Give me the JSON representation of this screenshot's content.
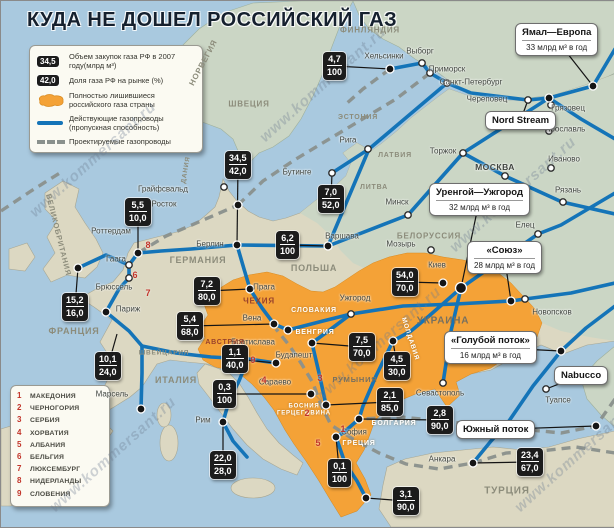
{
  "title": "КУДА НЕ ДОШЕЛ РОССИЙСКИЙ ГАЗ",
  "watermark_text": "www.kommersant.ru",
  "colors": {
    "sea": "#A9C9DF",
    "land_west": "#DCD8C2",
    "land_east": "#CBD6C5",
    "orange": "#F4A237",
    "pipeline_active": "#1474B8",
    "pipeline_planned": "#8A918D",
    "databox": "#1C1C1C",
    "red": "#C2342A"
  },
  "legend": {
    "purchases_value": "34,5",
    "purchases_label": "Объем закупок газа РФ в 2007 году(млрд м³)",
    "share_value": "42,0",
    "share_label": "Доля газа РФ на рынке (%)",
    "orange_label": "Полностью лишившиеся российского газа страны",
    "active_label": "Действующие газопроводы (пропускная способность)",
    "planned_label": "Проектируемые газопроводы"
  },
  "numbered_countries": [
    {
      "n": "1",
      "name": "МАКЕДОНИЯ"
    },
    {
      "n": "2",
      "name": "ЧЕРНОГОРИЯ"
    },
    {
      "n": "3",
      "name": "СЕРБИЯ"
    },
    {
      "n": "4",
      "name": "ХОРВАТИЯ"
    },
    {
      "n": "5",
      "name": "АЛБАНИЯ"
    },
    {
      "n": "6",
      "name": "БЕЛЬГИЯ"
    },
    {
      "n": "7",
      "name": "ЛЮКСЕМБУРГ"
    },
    {
      "n": "8",
      "name": "НИДЕРЛАНДЫ"
    },
    {
      "n": "9",
      "name": "СЛОВЕНИЯ"
    }
  ],
  "callouts": [
    {
      "id": "yamal-europe",
      "t": "Ямал—Европа",
      "s": "33 млрд м³ в год",
      "x": 514,
      "y": 22,
      "ax": 592,
      "ay": 85
    },
    {
      "id": "nord-stream",
      "t": "Nord Stream",
      "s": null,
      "x": 484,
      "y": 110,
      "ax": 527,
      "ay": 99
    },
    {
      "id": "urengoy-uzhgorod",
      "t": "Уренгой—Ужгород",
      "s": "32 млрд м³ в год",
      "x": 428,
      "y": 182,
      "ax": 460,
      "ay": 287
    },
    {
      "id": "soyuz",
      "t": "«Союз»",
      "s": "28 млрд м³ в год",
      "x": 466,
      "y": 240,
      "ax": 510,
      "ay": 300
    },
    {
      "id": "blue-stream",
      "t": "«Голубой поток»",
      "s": "16 млрд м³ в год",
      "x": 443,
      "y": 330,
      "ax": 560,
      "ay": 350
    },
    {
      "id": "nabucco",
      "t": "Nabucco",
      "s": null,
      "x": 553,
      "y": 365,
      "ax": 545,
      "ay": 388
    },
    {
      "id": "south-stream",
      "t": "Южный поток",
      "s": null,
      "x": 455,
      "y": 419,
      "ax": 595,
      "ay": 425
    }
  ],
  "databoxes": [
    {
      "a": "4,7",
      "b": "100",
      "x": 322,
      "y": 51,
      "ax": 389,
      "ay": 68
    },
    {
      "a": "34,5",
      "b": "42,0",
      "x": 224,
      "y": 150,
      "ax": 236,
      "ay": 244
    },
    {
      "a": "7,0",
      "b": "52,0",
      "x": 317,
      "y": 184,
      "ax": 331,
      "ay": 172
    },
    {
      "a": "5,5",
      "b": "10,0",
      "x": 124,
      "y": 197,
      "ax": 137,
      "ay": 252
    },
    {
      "a": "6,2",
      "b": "100",
      "x": 275,
      "y": 230,
      "ax": 327,
      "ay": 245
    },
    {
      "a": "15,2",
      "b": "16,0",
      "x": 61,
      "y": 292,
      "ax": 77,
      "ay": 267
    },
    {
      "a": "7,2",
      "b": "80,0",
      "x": 193,
      "y": 276,
      "ax": 249,
      "ay": 288
    },
    {
      "a": "5,4",
      "b": "68,0",
      "x": 176,
      "y": 311,
      "ax": 273,
      "ay": 323
    },
    {
      "a": "10,1",
      "b": "24,0",
      "x": 94,
      "y": 351,
      "ax": 116,
      "ay": 333
    },
    {
      "a": "1,1",
      "b": "40,0",
      "x": 221,
      "y": 344,
      "ax": 275,
      "ay": 362
    },
    {
      "a": "0,3",
      "b": "100",
      "x": 212,
      "y": 379,
      "ax": 310,
      "ay": 393
    },
    {
      "a": "22,0",
      "b": "28,0",
      "x": 209,
      "y": 450,
      "ax": 222,
      "ay": 421
    },
    {
      "a": "54,0",
      "b": "70,0",
      "x": 391,
      "y": 267,
      "ax": 442,
      "ay": 282
    },
    {
      "a": "7,5",
      "b": "70,0",
      "x": 348,
      "y": 332,
      "ax": 311,
      "ay": 342
    },
    {
      "a": "4,5",
      "b": "30,0",
      "x": 383,
      "y": 351,
      "ax": 392,
      "ay": 340
    },
    {
      "a": "2,1",
      "b": "85,0",
      "x": 376,
      "y": 387,
      "ax": 325,
      "ay": 404
    },
    {
      "a": "0,1",
      "b": "100",
      "x": 327,
      "y": 458,
      "ax": 335,
      "ay": 436
    },
    {
      "a": "2,8",
      "b": "90,0",
      "x": 426,
      "y": 405,
      "ax": 358,
      "ay": 418
    },
    {
      "a": "3,1",
      "b": "90,0",
      "x": 392,
      "y": 486,
      "ax": 365,
      "ay": 497
    },
    {
      "a": "23,4",
      "b": "67,0",
      "x": 516,
      "y": 447,
      "ax": 472,
      "ay": 462
    }
  ],
  "cities": [
    {
      "n": "Хельсинки",
      "x": 383,
      "y": 55,
      "dx": 389,
      "dy": 68,
      "dot": "b"
    },
    {
      "n": "Выборг",
      "x": 419,
      "y": 50,
      "dx": 421,
      "dy": 62,
      "dot": "w"
    },
    {
      "n": "Приморск",
      "x": 446,
      "y": 68,
      "dx": 429,
      "dy": 72,
      "dot": "w"
    },
    {
      "n": "Санкт-Петербург",
      "x": 470,
      "y": 81,
      "dx": 446,
      "dy": 82,
      "dot": "w"
    },
    {
      "n": "Череповец",
      "x": 486,
      "y": 98,
      "dx": 527,
      "dy": 99,
      "dot": "w"
    },
    {
      "n": "Грязовец",
      "x": 567,
      "y": 107,
      "dx": 550,
      "dy": 104,
      "dot": "w"
    },
    {
      "n": "Ярославль",
      "x": 564,
      "y": 128,
      "dx": 548,
      "dy": 130,
      "dot": "w"
    },
    {
      "n": "Иваново",
      "x": 563,
      "y": 158,
      "dx": 550,
      "dy": 167,
      "dot": "w"
    },
    {
      "n": "Торжок",
      "x": 442,
      "y": 150,
      "dx": 462,
      "dy": 152,
      "dot": "w"
    },
    {
      "n": "МОСКВА",
      "x": 494,
      "y": 166,
      "dx": 504,
      "dy": 175,
      "dot": "w",
      "caps": true
    },
    {
      "n": "Рязань",
      "x": 567,
      "y": 189,
      "dx": 562,
      "dy": 201,
      "dot": "w"
    },
    {
      "n": "Елец",
      "x": 524,
      "y": 224,
      "dx": 537,
      "dy": 233,
      "dot": "w"
    },
    {
      "n": "Новопсков",
      "x": 551,
      "y": 311,
      "dx": 524,
      "dy": 298,
      "dot": "w"
    },
    {
      "n": "Рига",
      "x": 347,
      "y": 139,
      "dx": 367,
      "dy": 148,
      "dot": "w"
    },
    {
      "n": "Минск",
      "x": 396,
      "y": 201,
      "dx": 407,
      "dy": 214,
      "dot": "w"
    },
    {
      "n": "Варшава",
      "x": 341,
      "y": 235,
      "dx": 327,
      "dy": 245,
      "dot": "b"
    },
    {
      "n": "Мозырь",
      "x": 400,
      "y": 243,
      "dx": 430,
      "dy": 249,
      "dot": "w"
    },
    {
      "n": "Киев",
      "x": 436,
      "y": 264,
      "dx": 442,
      "dy": 282,
      "dot": "b"
    },
    {
      "n": "Ужгород",
      "x": 354,
      "y": 297,
      "dx": 350,
      "dy": 313,
      "dot": "w"
    },
    {
      "n": "Берлин",
      "x": 209,
      "y": 243,
      "dx": 236,
      "dy": 244,
      "dot": "b"
    },
    {
      "n": "Грайфсвальд",
      "x": 162,
      "y": 188,
      "dx": 223,
      "dy": 186,
      "dot": "w"
    },
    {
      "n": "Росток",
      "x": 163,
      "y": 203,
      "dx": 237,
      "dy": 204,
      "dot": "b"
    },
    {
      "n": "Бутинге",
      "x": 296,
      "y": 171,
      "dx": 331,
      "dy": 172,
      "dot": "w"
    },
    {
      "n": "Роттердам",
      "x": 110,
      "y": 230,
      "dx": 137,
      "dy": 252,
      "dot": "b"
    },
    {
      "n": "Гаага",
      "x": 115,
      "y": 258,
      "dx": 128,
      "dy": 264,
      "dot": "w"
    },
    {
      "n": "Брюссель",
      "x": 113,
      "y": 286,
      "dx": 128,
      "dy": 277,
      "dot": "w"
    },
    {
      "n": "Париж",
      "x": 127,
      "y": 308,
      "dx": 105,
      "dy": 311,
      "dot": "b"
    },
    {
      "n": "Марсель",
      "x": 111,
      "y": 393,
      "dx": 140,
      "dy": 408,
      "dot": "b"
    },
    {
      "n": "Прага",
      "x": 263,
      "y": 286,
      "dx": 249,
      "dy": 288,
      "dot": "b"
    },
    {
      "n": "Вена",
      "x": 251,
      "y": 317,
      "dx": 273,
      "dy": 323,
      "dot": "b"
    },
    {
      "n": "Братислава",
      "x": 252,
      "y": 341,
      "dx": 287,
      "dy": 329,
      "dot": "b"
    },
    {
      "n": "Будапешт",
      "x": 293,
      "y": 354,
      "dx": 311,
      "dy": 342,
      "dot": "b"
    },
    {
      "n": "Сараево",
      "x": 274,
      "y": 381,
      "dx": 310,
      "dy": 393,
      "dot": "b"
    },
    {
      "n": "Рим",
      "x": 202,
      "y": 419,
      "dx": 222,
      "dy": 421,
      "dot": "b"
    },
    {
      "n": "София",
      "x": 353,
      "y": 431,
      "dx": 335,
      "dy": 436,
      "dot": "b"
    },
    {
      "n": "Севастополь",
      "x": 439,
      "y": 392,
      "dx": 442,
      "dy": 382,
      "dot": "w"
    },
    {
      "n": "Туапсе",
      "x": 557,
      "y": 399,
      "dx": 595,
      "dy": 425,
      "dot": "b"
    },
    {
      "n": "Анкара",
      "x": 441,
      "y": 458,
      "dx": 472,
      "dy": 462,
      "dot": "b"
    }
  ],
  "extra_dots": [
    {
      "x": 592,
      "y": 85,
      "dot": "b"
    },
    {
      "x": 548,
      "y": 97,
      "dot": "b"
    },
    {
      "x": 460,
      "y": 287,
      "dot": "bb"
    },
    {
      "x": 510,
      "y": 300,
      "dot": "b"
    },
    {
      "x": 560,
      "y": 350,
      "dot": "b"
    },
    {
      "x": 545,
      "y": 388,
      "dot": "w"
    },
    {
      "x": 77,
      "y": 267,
      "dot": "b"
    },
    {
      "x": 275,
      "y": 362,
      "dot": "b"
    },
    {
      "x": 325,
      "y": 404,
      "dot": "b"
    },
    {
      "x": 358,
      "y": 418,
      "dot": "b"
    },
    {
      "x": 392,
      "y": 340,
      "dot": "b"
    },
    {
      "x": 365,
      "y": 497,
      "dot": "b"
    }
  ],
  "countries": [
    {
      "n": "НОРВЕГИЯ",
      "x": 203,
      "y": 62,
      "r": -62,
      "c": "#8C8C7B",
      "s": 8
    },
    {
      "n": "ШВЕЦИЯ",
      "x": 248,
      "y": 104,
      "r": 0,
      "c": "#8C8C7B",
      "s": 8
    },
    {
      "n": "ФИНЛЯНДИЯ",
      "x": 369,
      "y": 30,
      "r": 0,
      "c": "#8C8C7B",
      "s": 8
    },
    {
      "n": "ЭСТОНИЯ",
      "x": 357,
      "y": 117,
      "r": 0,
      "c": "#8C8C7B",
      "s": 7
    },
    {
      "n": "ЛАТВИЯ",
      "x": 394,
      "y": 155,
      "r": 0,
      "c": "#8C8C7B",
      "s": 7
    },
    {
      "n": "ЛИТВА",
      "x": 373,
      "y": 187,
      "r": 0,
      "c": "#8C8C7B",
      "s": 7
    },
    {
      "n": "БЕЛОРУССИЯ",
      "x": 428,
      "y": 236,
      "r": 0,
      "c": "#8C8C7B",
      "s": 8
    },
    {
      "n": "ПОЛЬША",
      "x": 313,
      "y": 268,
      "r": 0,
      "c": "#8C8C7B",
      "s": 9
    },
    {
      "n": "ГЕРМАНИЯ",
      "x": 197,
      "y": 260,
      "r": 0,
      "c": "#8C8C7B",
      "s": 9
    },
    {
      "n": "ВЕЛИКОБРИТАНИЯ",
      "x": 57,
      "y": 234,
      "r": 76,
      "c": "#8C8C7B",
      "s": 7.5
    },
    {
      "n": "ФРАНЦИЯ",
      "x": 73,
      "y": 331,
      "r": 0,
      "c": "#8C8C7B",
      "s": 9
    },
    {
      "n": "ЧЕХИЯ",
      "x": 258,
      "y": 301,
      "r": 0,
      "c": "#99422B",
      "s": 8
    },
    {
      "n": "СЛОВАКИЯ",
      "x": 313,
      "y": 310,
      "r": 0,
      "c": "#FFFFFF",
      "s": 7
    },
    {
      "n": "АВСТРИЯ",
      "x": 224,
      "y": 342,
      "r": 0,
      "c": "#99422B",
      "s": 7
    },
    {
      "n": "ШВЕЙЦАРИЯ",
      "x": 163,
      "y": 352,
      "r": 0,
      "c": "#8C8C7B",
      "s": 6.5
    },
    {
      "n": "ИТАЛИЯ",
      "x": 175,
      "y": 380,
      "r": 0,
      "c": "#8C8C7B",
      "s": 9
    },
    {
      "n": "ВЕНГРИЯ",
      "x": 314,
      "y": 332,
      "r": 0,
      "c": "#FFFFFF",
      "s": 7
    },
    {
      "n": "УКРАИНА",
      "x": 442,
      "y": 320,
      "r": 0,
      "c": "#77705F",
      "s": 10
    },
    {
      "n": "МОЛДАВИЯ",
      "x": 409,
      "y": 338,
      "r": 72,
      "c": "#FFFFFF",
      "s": 6.5
    },
    {
      "n": "РУМЫНИЯ",
      "x": 354,
      "y": 379,
      "r": 0,
      "c": "#77705F",
      "s": 7.5
    },
    {
      "n": "БОЛГАРИЯ",
      "x": 393,
      "y": 423,
      "r": 0,
      "c": "#FFFFFF",
      "s": 7
    },
    {
      "n": "БОСНИЯ\nГЕРЦЕГОВИНА",
      "x": 303,
      "y": 409,
      "r": 0,
      "c": "#FFFFFF",
      "s": 6
    },
    {
      "n": "ГРЕЦИЯ",
      "x": 358,
      "y": 443,
      "r": 0,
      "c": "#FFFFFF",
      "s": 7
    },
    {
      "n": "ТУРЦИЯ",
      "x": 506,
      "y": 490,
      "r": 0,
      "c": "#8C8C7B",
      "s": 10
    },
    {
      "n": "ДАНИЯ",
      "x": 185,
      "y": 169,
      "r": -80,
      "c": "#8C8C7B",
      "s": 6.5
    }
  ],
  "red_markers": [
    {
      "n": "1",
      "x": 342,
      "y": 428
    },
    {
      "n": "2",
      "x": 306,
      "y": 412
    },
    {
      "n": "3",
      "x": 319,
      "y": 377
    },
    {
      "n": "4",
      "x": 263,
      "y": 379
    },
    {
      "n": "5",
      "x": 317,
      "y": 442
    },
    {
      "n": "6",
      "x": 134,
      "y": 274
    },
    {
      "n": "7",
      "x": 147,
      "y": 292
    },
    {
      "n": "8",
      "x": 147,
      "y": 244
    },
    {
      "n": "9",
      "x": 252,
      "y": 359
    }
  ],
  "watermarks": [
    {
      "x": 10,
      "y": 150,
      "r": -42
    },
    {
      "x": 240,
      "y": 75,
      "r": -42
    },
    {
      "x": 430,
      "y": 185,
      "r": -42
    },
    {
      "x": 30,
      "y": 445,
      "r": -42
    },
    {
      "x": 295,
      "y": 335,
      "r": -42
    },
    {
      "x": 495,
      "y": 445,
      "r": -42
    }
  ]
}
